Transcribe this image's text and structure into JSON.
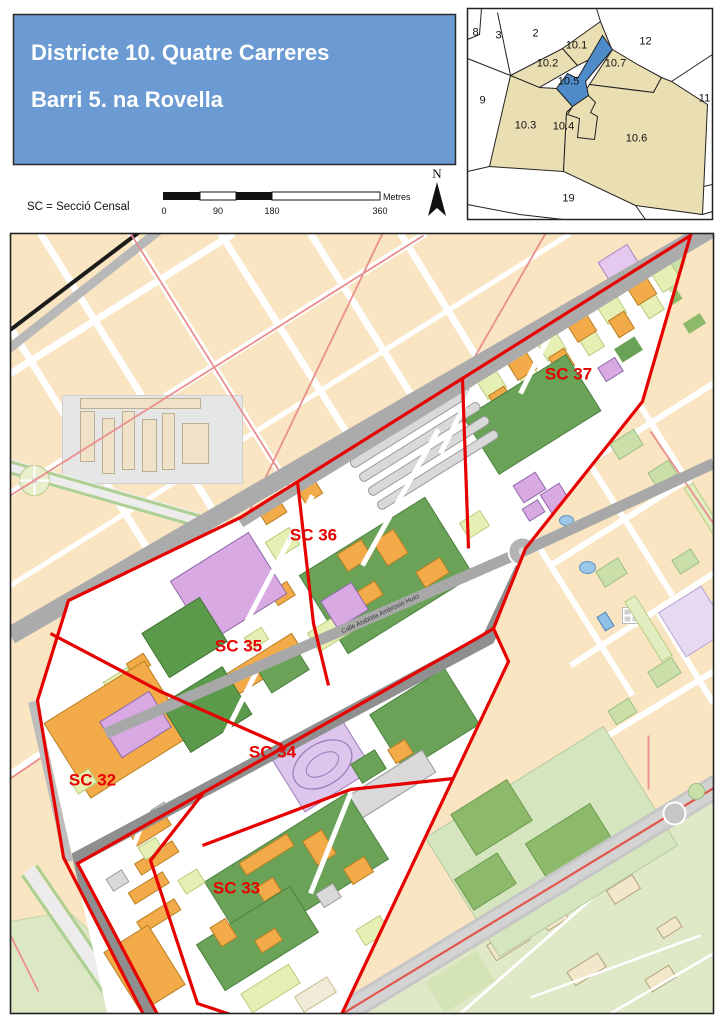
{
  "header": {
    "line1": "Districte 10. Quatre Carreres",
    "line2": "Barri 5. na Rovella"
  },
  "legend": {
    "sc_note": "SC = Secció Censal"
  },
  "scalebar": {
    "t0": "0",
    "t90": "90",
    "t180": "180",
    "t360": "360",
    "unit": "Metres"
  },
  "north": {
    "label": "N"
  },
  "inset": {
    "n8": "8",
    "n3": "3",
    "n2": "2",
    "n101": "10.1",
    "n12": "12",
    "n102": "10.2",
    "n107": "10.7",
    "n105": "10.5",
    "n9": "9",
    "n11": "11",
    "n103": "10.3",
    "n104": "10.4",
    "n106": "10.6",
    "n19": "19"
  },
  "map": {
    "sc37": "SC 37",
    "sc36": "SC 36",
    "sc35": "SC 35",
    "sc34": "SC 34",
    "sc33": "SC 33",
    "sc32": "SC 32",
    "street": "Calle Arabista Ambrosio Huici"
  },
  "colors": {
    "title_bg": "#6b9bd2",
    "boundary": "#e60000",
    "highlight": "#4f8bc9",
    "district_fill": "#eadfb3"
  }
}
